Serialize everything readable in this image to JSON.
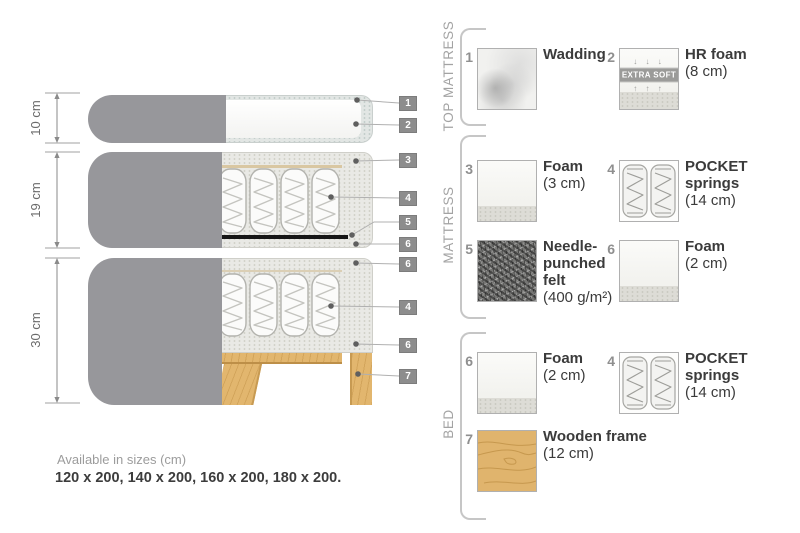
{
  "diagram": {
    "dim_labels": [
      "10 cm",
      "19 cm",
      "30 cm"
    ],
    "callouts": [
      "1",
      "2",
      "3",
      "4",
      "5",
      "6",
      "6",
      "4",
      "6",
      "7"
    ]
  },
  "legend": {
    "groups": [
      "TOP MATTRESS",
      "MATTRESS",
      "BED"
    ],
    "items": [
      {
        "num": "1",
        "name": "Wadding",
        "size": ""
      },
      {
        "num": "2",
        "name": "HR foam",
        "size": "(8 cm)",
        "badge": "EXTRA SOFT",
        "arrows_down": "↓ ↓ ↓",
        "arrows_up": "↑ ↑ ↑"
      },
      {
        "num": "3",
        "name": "Foam",
        "size": "(3 cm)"
      },
      {
        "num": "4",
        "name": "POCKET\nsprings",
        "size": "(14 cm)"
      },
      {
        "num": "5",
        "name": "Needle-\npunched\nfelt",
        "size": "(400 g/m²)"
      },
      {
        "num": "6",
        "name": "Foam",
        "size": "(2 cm)"
      },
      {
        "num": "6",
        "name": "Foam",
        "size": "(2 cm)"
      },
      {
        "num": "4",
        "name": "POCKET\nsprings",
        "size": "(14 cm)"
      },
      {
        "num": "7",
        "name": "Wooden frame",
        "size": "(12 cm)"
      }
    ]
  },
  "footer": {
    "line1": "Available in sizes (cm)",
    "line2": "120 x 200, 140 x 200, 160 x 200, 180 x 200."
  },
  "colors": {
    "fabric_gray": "#97979b",
    "foam_speckle": "#e9e9e5",
    "wadding": "#e2e6e4",
    "wood": "#e2b66e",
    "felt_dark": "#757573",
    "callout_box": "#8d8d8d",
    "text_dark": "#3b3b3b",
    "text_gray": "#9c9c9c"
  }
}
